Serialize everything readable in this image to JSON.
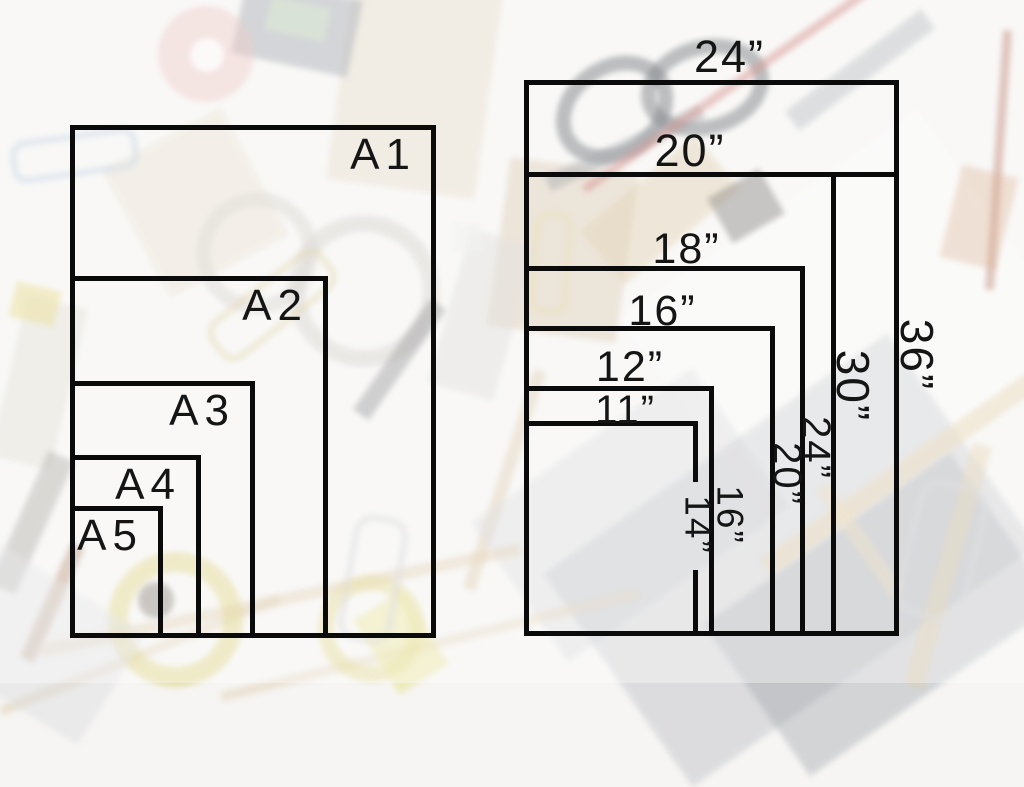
{
  "colors": {
    "line": "#0b0b0b",
    "text": "#151515",
    "background": "#f6f5f3"
  },
  "left_diagram": {
    "labels": [
      {
        "label": "A1"
      },
      {
        "label": "A2"
      },
      {
        "label": "A3"
      },
      {
        "label": "A4"
      },
      {
        "label": "A5"
      }
    ]
  },
  "right_diagram": {
    "sizes": [
      {
        "width_label": "24”",
        "height_label": "36”"
      },
      {
        "width_label": "20”",
        "height_label": "30”"
      },
      {
        "width_label": "18”",
        "height_label": "24”"
      },
      {
        "width_label": "16”",
        "height_label": "20”"
      },
      {
        "width_label": "12”",
        "height_label": "16”"
      },
      {
        "width_label": "11”",
        "height_label": "14”"
      }
    ]
  },
  "diagram_data": {
    "type": "nested-rectangles-size-comparison",
    "a_series": [
      "A1",
      "A2",
      "A3",
      "A4",
      "A5"
    ],
    "imperial_inches": [
      [
        24,
        36
      ],
      [
        20,
        30
      ],
      [
        18,
        24
      ],
      [
        16,
        20
      ],
      [
        12,
        16
      ],
      [
        11,
        14
      ]
    ]
  }
}
